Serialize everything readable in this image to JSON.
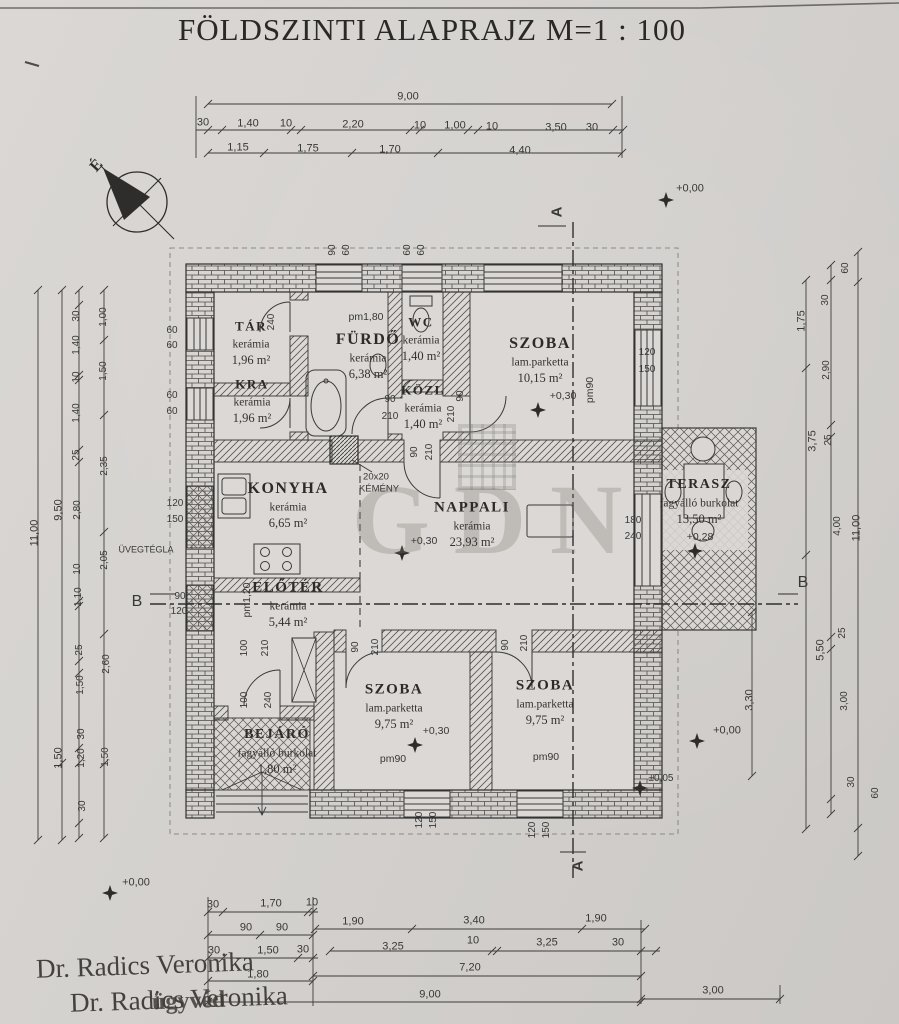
{
  "title": "FÖLDSZINTI ALAPRAJZ M=1 : 100",
  "compass": {
    "north": "É"
  },
  "watermark": {
    "text": "GDN"
  },
  "stamp": {
    "line1": "Dr. Radics Veronika",
    "line2": "Dr. Radics Veronika",
    "overlay": "ügyvéd"
  },
  "rooms": [
    {
      "id": "tar",
      "name": "TÁR",
      "finish": "kerámia",
      "area": "1,96 m²",
      "x": 251,
      "y": 326,
      "ns": 13
    },
    {
      "id": "furdo",
      "name": "FÜRDŐ",
      "finish": "kerámia",
      "area": "6,38 m²",
      "x": 368,
      "y": 340,
      "ns": 16
    },
    {
      "id": "wc",
      "name": "WC",
      "finish": "kerámia",
      "area": "1,40 m²",
      "x": 421,
      "y": 322,
      "ns": 13
    },
    {
      "id": "kozl",
      "name": "KÖZL",
      "finish": "kerámia",
      "area": "1,40 m²",
      "x": 423,
      "y": 390,
      "ns": 13
    },
    {
      "id": "szoba-felso",
      "name": "SZOBA",
      "finish": "lam.parketta",
      "area": "10,15 m²",
      "x": 540,
      "y": 344,
      "ns": 16
    },
    {
      "id": "kamra",
      "name": "KRA",
      "finish": "kerámia",
      "area": "1,96 m²",
      "x": 252,
      "y": 384,
      "ns": 13
    },
    {
      "id": "konyha",
      "name": "KONYHA",
      "finish": "kerámia",
      "area": "6,65 m²",
      "x": 288,
      "y": 489,
      "ns": 16
    },
    {
      "id": "nappali",
      "name": "NAPPALI",
      "finish": "kerámia",
      "area": "23,93 m²",
      "x": 472,
      "y": 508,
      "ns": 15
    },
    {
      "id": "terasz",
      "name": "TERASZ",
      "finish": "fagyálló burkolat",
      "area": "13,50 m²",
      "x": 699,
      "y": 485,
      "ns": 14
    },
    {
      "id": "eloter",
      "name": "ELŐTÉR",
      "finish": "kerámia",
      "area": "5,44 m²",
      "x": 288,
      "y": 588,
      "ns": 15
    },
    {
      "id": "szoba-bal",
      "name": "SZOBA",
      "finish": "lam.parketta",
      "area": "9,75 m²",
      "x": 394,
      "y": 690,
      "ns": 15
    },
    {
      "id": "szoba-jobb",
      "name": "SZOBA",
      "finish": "lam.parketta",
      "area": "9,75 m²",
      "x": 545,
      "y": 686,
      "ns": 15
    },
    {
      "id": "bejaro",
      "name": "BEJÁRÓ",
      "finish": "fagyálló burkolat",
      "area": "1,80 m²",
      "x": 277,
      "y": 735,
      "ns": 14
    }
  ],
  "labels": [
    {
      "t": "9,00",
      "x": 408,
      "y": 97
    },
    {
      "t": "30",
      "x": 203,
      "y": 123
    },
    {
      "t": "1,40",
      "x": 248,
      "y": 124
    },
    {
      "t": "10",
      "x": 286,
      "y": 124
    },
    {
      "t": "2,20",
      "x": 353,
      "y": 125
    },
    {
      "t": "10",
      "x": 420,
      "y": 126
    },
    {
      "t": "1,00",
      "x": 455,
      "y": 126
    },
    {
      "t": "10",
      "x": 492,
      "y": 127
    },
    {
      "t": "3,50",
      "x": 556,
      "y": 128
    },
    {
      "t": "30",
      "x": 592,
      "y": 128
    },
    {
      "t": "1,15",
      "x": 238,
      "y": 148
    },
    {
      "t": "1,75",
      "x": 308,
      "y": 149
    },
    {
      "t": "1,70",
      "x": 390,
      "y": 150
    },
    {
      "t": "4,40",
      "x": 520,
      "y": 151
    },
    {
      "t": "90",
      "x": 333,
      "y": 250,
      "r": -90,
      "s": 10
    },
    {
      "t": "60",
      "x": 347,
      "y": 250,
      "r": -90,
      "s": 10
    },
    {
      "t": "60",
      "x": 408,
      "y": 250,
      "r": -90,
      "s": 10
    },
    {
      "t": "60",
      "x": 422,
      "y": 250,
      "r": -90,
      "s": 10
    },
    {
      "t": "11,00",
      "x": 35,
      "y": 533,
      "r": -90
    },
    {
      "t": "9,50",
      "x": 59,
      "y": 510,
      "r": -90
    },
    {
      "t": "1,50",
      "x": 59,
      "y": 758,
      "r": -90
    },
    {
      "t": "30",
      "x": 77,
      "y": 316,
      "r": -90,
      "s": 10
    },
    {
      "t": "1,40",
      "x": 77,
      "y": 345,
      "r": -90,
      "s": 10
    },
    {
      "t": "10",
      "x": 77,
      "y": 377,
      "r": -90,
      "s": 10
    },
    {
      "t": "1,40",
      "x": 77,
      "y": 413,
      "r": -90,
      "s": 10
    },
    {
      "t": "25",
      "x": 77,
      "y": 455,
      "r": -90,
      "s": 10
    },
    {
      "t": "2,80",
      "x": 78,
      "y": 510,
      "r": -90,
      "s": 10
    },
    {
      "t": "10",
      "x": 78,
      "y": 569,
      "r": -90,
      "s": 10
    },
    {
      "t": "1,10",
      "x": 79,
      "y": 597,
      "r": -90,
      "s": 10
    },
    {
      "t": "25",
      "x": 80,
      "y": 650,
      "r": -90,
      "s": 10
    },
    {
      "t": "1,50",
      "x": 81,
      "y": 685,
      "r": -90,
      "s": 10
    },
    {
      "t": "30",
      "x": 82,
      "y": 734,
      "r": -90,
      "s": 10
    },
    {
      "t": "1,20",
      "x": 82,
      "y": 758,
      "r": -90,
      "s": 10
    },
    {
      "t": "30",
      "x": 83,
      "y": 806,
      "r": -90,
      "s": 10
    },
    {
      "t": "1,00",
      "x": 104,
      "y": 317,
      "r": -90,
      "s": 10
    },
    {
      "t": "1,50",
      "x": 104,
      "y": 371,
      "r": -90,
      "s": 10
    },
    {
      "t": "2,35",
      "x": 105,
      "y": 466,
      "r": -90,
      "s": 10
    },
    {
      "t": "2,05",
      "x": 105,
      "y": 560,
      "r": -90,
      "s": 10
    },
    {
      "t": "2,60",
      "x": 107,
      "y": 664,
      "r": -90,
      "s": 10
    },
    {
      "t": "1,50",
      "x": 106,
      "y": 757,
      "r": -90,
      "s": 10
    },
    {
      "t": "60",
      "x": 172,
      "y": 331,
      "s": 10
    },
    {
      "t": "60",
      "x": 172,
      "y": 346,
      "s": 10
    },
    {
      "t": "60",
      "x": 172,
      "y": 396,
      "s": 10
    },
    {
      "t": "60",
      "x": 172,
      "y": 412,
      "s": 10
    },
    {
      "t": "120",
      "x": 175,
      "y": 504,
      "s": 10
    },
    {
      "t": "150",
      "x": 175,
      "y": 520,
      "s": 10
    },
    {
      "t": "ÜVEGTÉGLA",
      "x": 146,
      "y": 550,
      "s": 9
    },
    {
      "t": "90",
      "x": 180,
      "y": 597,
      "s": 10
    },
    {
      "t": "120",
      "x": 179,
      "y": 612,
      "s": 10
    },
    {
      "t": "B",
      "x": 137,
      "y": 602,
      "s": 16
    },
    {
      "t": "B",
      "x": 803,
      "y": 583,
      "s": 16
    },
    {
      "t": "1,75",
      "x": 802,
      "y": 321,
      "r": -90
    },
    {
      "t": "3,75",
      "x": 813,
      "y": 441,
      "r": -90
    },
    {
      "t": "5,50",
      "x": 821,
      "y": 650,
      "r": -90
    },
    {
      "t": "30",
      "x": 826,
      "y": 300,
      "r": -90,
      "s": 10
    },
    {
      "t": "2,90",
      "x": 827,
      "y": 370,
      "r": -90,
      "s": 10
    },
    {
      "t": "25",
      "x": 829,
      "y": 440,
      "r": -90,
      "s": 10
    },
    {
      "t": "4,00",
      "x": 838,
      "y": 526,
      "r": -90,
      "s": 10
    },
    {
      "t": "25",
      "x": 843,
      "y": 633,
      "r": -90,
      "s": 10
    },
    {
      "t": "3,00",
      "x": 845,
      "y": 701,
      "r": -90,
      "s": 10
    },
    {
      "t": "30",
      "x": 852,
      "y": 782,
      "r": -90,
      "s": 10
    },
    {
      "t": "60",
      "x": 846,
      "y": 268,
      "r": -90,
      "s": 10
    },
    {
      "t": "11,00",
      "x": 857,
      "y": 528,
      "r": -90
    },
    {
      "t": "60",
      "x": 876,
      "y": 793,
      "r": -90,
      "s": 10
    },
    {
      "t": "3,30",
      "x": 750,
      "y": 700,
      "r": -90
    },
    {
      "t": "120",
      "x": 647,
      "y": 353,
      "s": 10
    },
    {
      "t": "150",
      "x": 647,
      "y": 370,
      "s": 10
    },
    {
      "t": "180",
      "x": 633,
      "y": 521,
      "s": 10
    },
    {
      "t": "240",
      "x": 633,
      "y": 537,
      "s": 10
    },
    {
      "t": "30",
      "x": 213,
      "y": 905
    },
    {
      "t": "1,70",
      "x": 271,
      "y": 904
    },
    {
      "t": "10",
      "x": 312,
      "y": 903
    },
    {
      "t": "90",
      "x": 246,
      "y": 928
    },
    {
      "t": "90",
      "x": 282,
      "y": 928
    },
    {
      "t": "1,90",
      "x": 353,
      "y": 922
    },
    {
      "t": "3,40",
      "x": 474,
      "y": 921
    },
    {
      "t": "1,90",
      "x": 596,
      "y": 919
    },
    {
      "t": "30",
      "x": 214,
      "y": 951
    },
    {
      "t": "1,50",
      "x": 268,
      "y": 951
    },
    {
      "t": "30",
      "x": 303,
      "y": 950
    },
    {
      "t": "3,25",
      "x": 393,
      "y": 947
    },
    {
      "t": "10",
      "x": 473,
      "y": 941
    },
    {
      "t": "3,25",
      "x": 547,
      "y": 943
    },
    {
      "t": "30",
      "x": 618,
      "y": 943
    },
    {
      "t": "1,80",
      "x": 258,
      "y": 975
    },
    {
      "t": "7,20",
      "x": 470,
      "y": 968
    },
    {
      "t": "9,00",
      "x": 430,
      "y": 995
    },
    {
      "t": "3,00",
      "x": 713,
      "y": 991
    },
    {
      "t": "240",
      "x": 272,
      "y": 322,
      "r": -90,
      "s": 10
    },
    {
      "t": "90",
      "x": 390,
      "y": 400,
      "s": 10
    },
    {
      "t": "210",
      "x": 390,
      "y": 417,
      "s": 10
    },
    {
      "t": "90",
      "x": 461,
      "y": 396,
      "r": -90,
      "s": 10
    },
    {
      "t": "210",
      "x": 452,
      "y": 414,
      "r": -90,
      "s": 10
    },
    {
      "t": "90",
      "x": 415,
      "y": 452,
      "r": -90,
      "s": 10
    },
    {
      "t": "210",
      "x": 430,
      "y": 452,
      "r": -90,
      "s": 10
    },
    {
      "t": "90",
      "x": 356,
      "y": 647,
      "r": -90,
      "s": 10
    },
    {
      "t": "210",
      "x": 376,
      "y": 647,
      "r": -90,
      "s": 10
    },
    {
      "t": "90",
      "x": 506,
      "y": 645,
      "r": -90,
      "s": 10
    },
    {
      "t": "210",
      "x": 525,
      "y": 643,
      "r": -90,
      "s": 10
    },
    {
      "t": "100",
      "x": 245,
      "y": 648,
      "r": -90,
      "s": 10
    },
    {
      "t": "210",
      "x": 266,
      "y": 648,
      "r": -90,
      "s": 10
    },
    {
      "t": "100",
      "x": 245,
      "y": 700,
      "r": -90,
      "s": 10
    },
    {
      "t": "240",
      "x": 269,
      "y": 700,
      "r": -90,
      "s": 10
    },
    {
      "t": "120",
      "x": 420,
      "y": 820,
      "r": -90,
      "s": 10
    },
    {
      "t": "150",
      "x": 434,
      "y": 820,
      "r": -90,
      "s": 10
    },
    {
      "t": "120",
      "x": 533,
      "y": 830,
      "r": -90,
      "s": 10
    },
    {
      "t": "150",
      "x": 547,
      "y": 830,
      "r": -90,
      "s": 10
    },
    {
      "t": "pm1,80",
      "x": 366,
      "y": 317,
      "s": 10.5
    },
    {
      "t": "pm90",
      "x": 590,
      "y": 390,
      "r": -90,
      "s": 10.5
    },
    {
      "t": "pm1,20",
      "x": 247,
      "y": 600,
      "r": -90,
      "s": 10.5
    },
    {
      "t": "pm90",
      "x": 393,
      "y": 759,
      "s": 10.5
    },
    {
      "t": "pm90",
      "x": 546,
      "y": 757,
      "s": 10.5
    },
    {
      "t": "+0,00",
      "x": 690,
      "y": 189
    },
    {
      "t": "+0,30",
      "x": 563,
      "y": 396,
      "s": 10.5
    },
    {
      "t": "+0,30",
      "x": 424,
      "y": 541,
      "s": 10.5
    },
    {
      "t": "+0,28",
      "x": 700,
      "y": 537,
      "s": 10.5
    },
    {
      "t": "+0,30",
      "x": 436,
      "y": 731,
      "s": 10.5
    },
    {
      "t": "+0,00",
      "x": 727,
      "y": 731
    },
    {
      "t": "+0,00",
      "x": 136,
      "y": 883
    },
    {
      "t": "±0,05",
      "x": 661,
      "y": 779,
      "s": 10
    },
    {
      "t": "A",
      "x": 557,
      "y": 212,
      "r": -90,
      "s": 15,
      "b": 1
    },
    {
      "t": "A",
      "x": 578,
      "y": 866,
      "r": -90,
      "s": 15,
      "b": 1
    },
    {
      "t": "20x20",
      "x": 376,
      "y": 477,
      "s": 9.5
    },
    {
      "t": "KÉMÉNY",
      "x": 379,
      "y": 489,
      "s": 9.5
    }
  ]
}
